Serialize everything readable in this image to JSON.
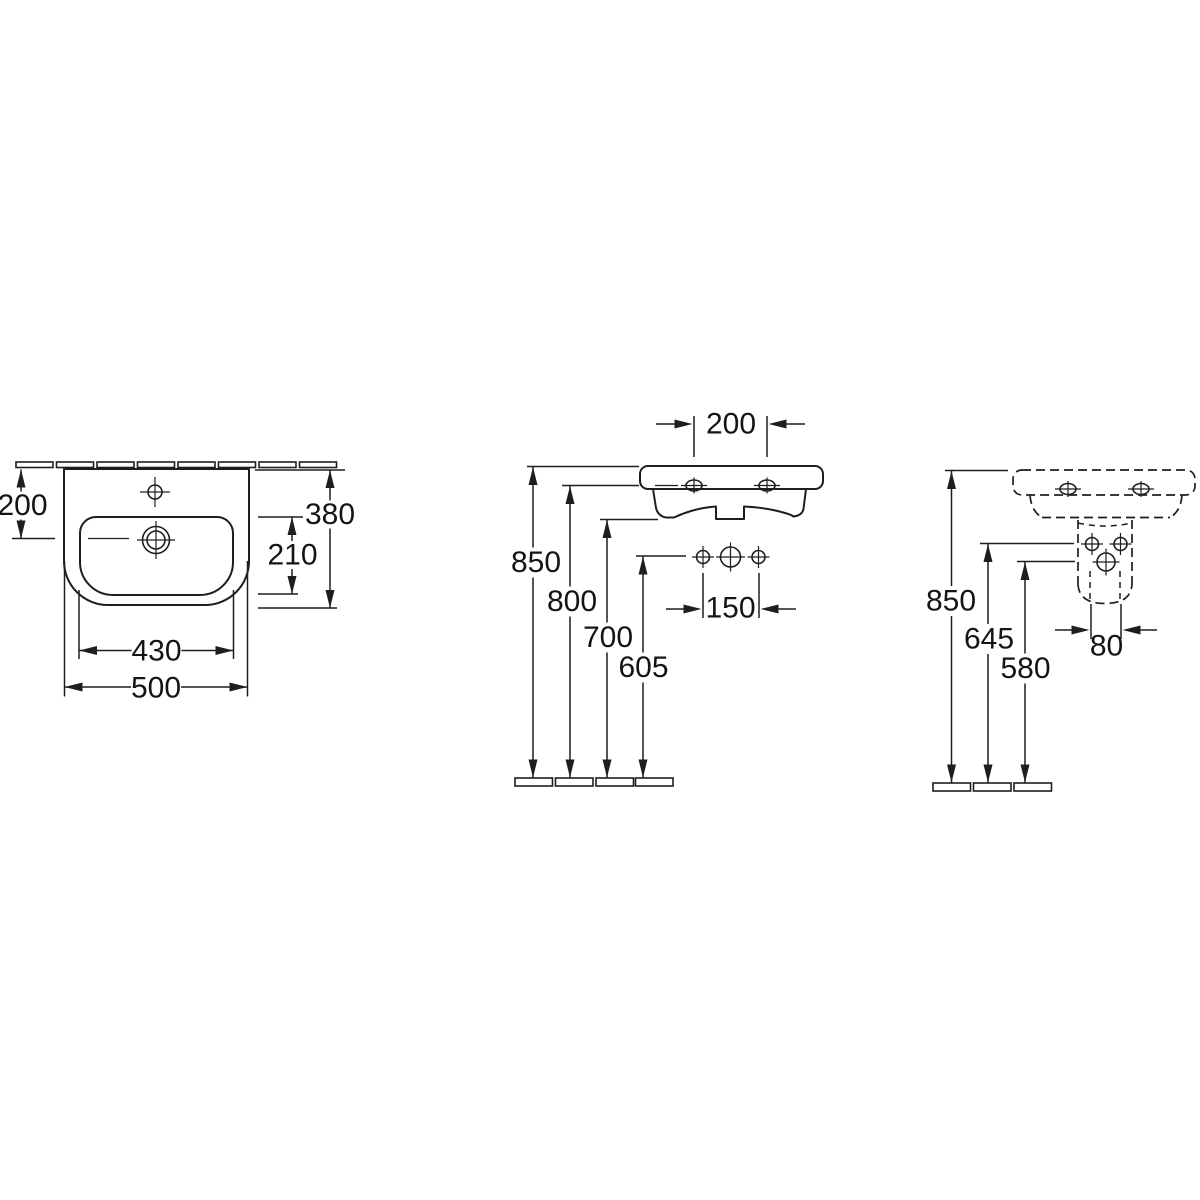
{
  "views": {
    "plan": {
      "dims": {
        "wall_to_drain": "200",
        "overall_depth": "380",
        "bowl_depth": "210",
        "bowl_width": "430",
        "overall_width": "500"
      }
    },
    "side": {
      "dims": {
        "hole_spacing": "200",
        "height_rim": "850",
        "height_fixing_holes": "800",
        "height_underside": "700",
        "height_connections": "605",
        "connection_spacing": "150"
      }
    },
    "rear": {
      "dims": {
        "height_rim": "850",
        "height_connections": "645",
        "height_waste": "580",
        "waste_width": "80"
      }
    }
  }
}
